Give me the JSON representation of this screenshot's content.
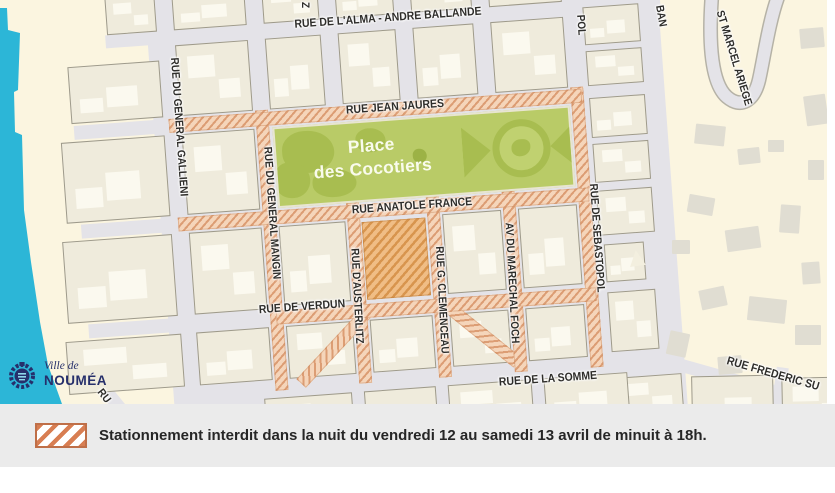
{
  "place": {
    "line1": "Place",
    "line2": "des Cocotiers"
  },
  "streets": {
    "alma": "RUE DE L'ALMA - ANDRE BALLANDE",
    "jean_jaures": "RUE JEAN JAURES",
    "anatole_france": "RUE ANATOLE FRANCE",
    "verdun": "RUE DE VERDUN",
    "somme": "RUE DE LA SOMME",
    "gallieni": "RUE DU GENERAL GALLIENI",
    "mangin": "RUE DU GENERAL MANGIN",
    "austerlitz": "RUE D'AUSTERLITZ",
    "clemenceau": "RUE G. CLEMENCEAU",
    "foch": "AV DU MARECHAL FOCH",
    "sebastopol": "RUE DE SEBASTOPOL",
    "st_marcel": "ST MARCEL ARIEGE",
    "frederic": "RUE FREDERIC SU",
    "sebastopol_north_fragment": "POL",
    "ban_fragment": "BAN",
    "top_fragment": "Z",
    "bottom_left_fragment": "RU"
  },
  "logo": {
    "line1": "Ville de",
    "line2": "NOUMÉA"
  },
  "legend": {
    "text": "Stationnement interdit dans la nuit du vendredi 12 au samedi 13 avril de minuit à 18h."
  },
  "colors": {
    "water": "#2cb6d7",
    "land": "#fbf5e0",
    "block": "#efebdc",
    "street": "#e4e3e8",
    "no_parking_bg": "#f5d5ba",
    "no_parking_stripe": "#dc9d74",
    "parking_lot_stripe": "#d8954e",
    "park_green": "#b9cb67",
    "tree_green": "#a8bd50",
    "legend_stripe": "#d87e52",
    "legend_band": "#ebebeb",
    "logo_navy": "#262f6b"
  }
}
